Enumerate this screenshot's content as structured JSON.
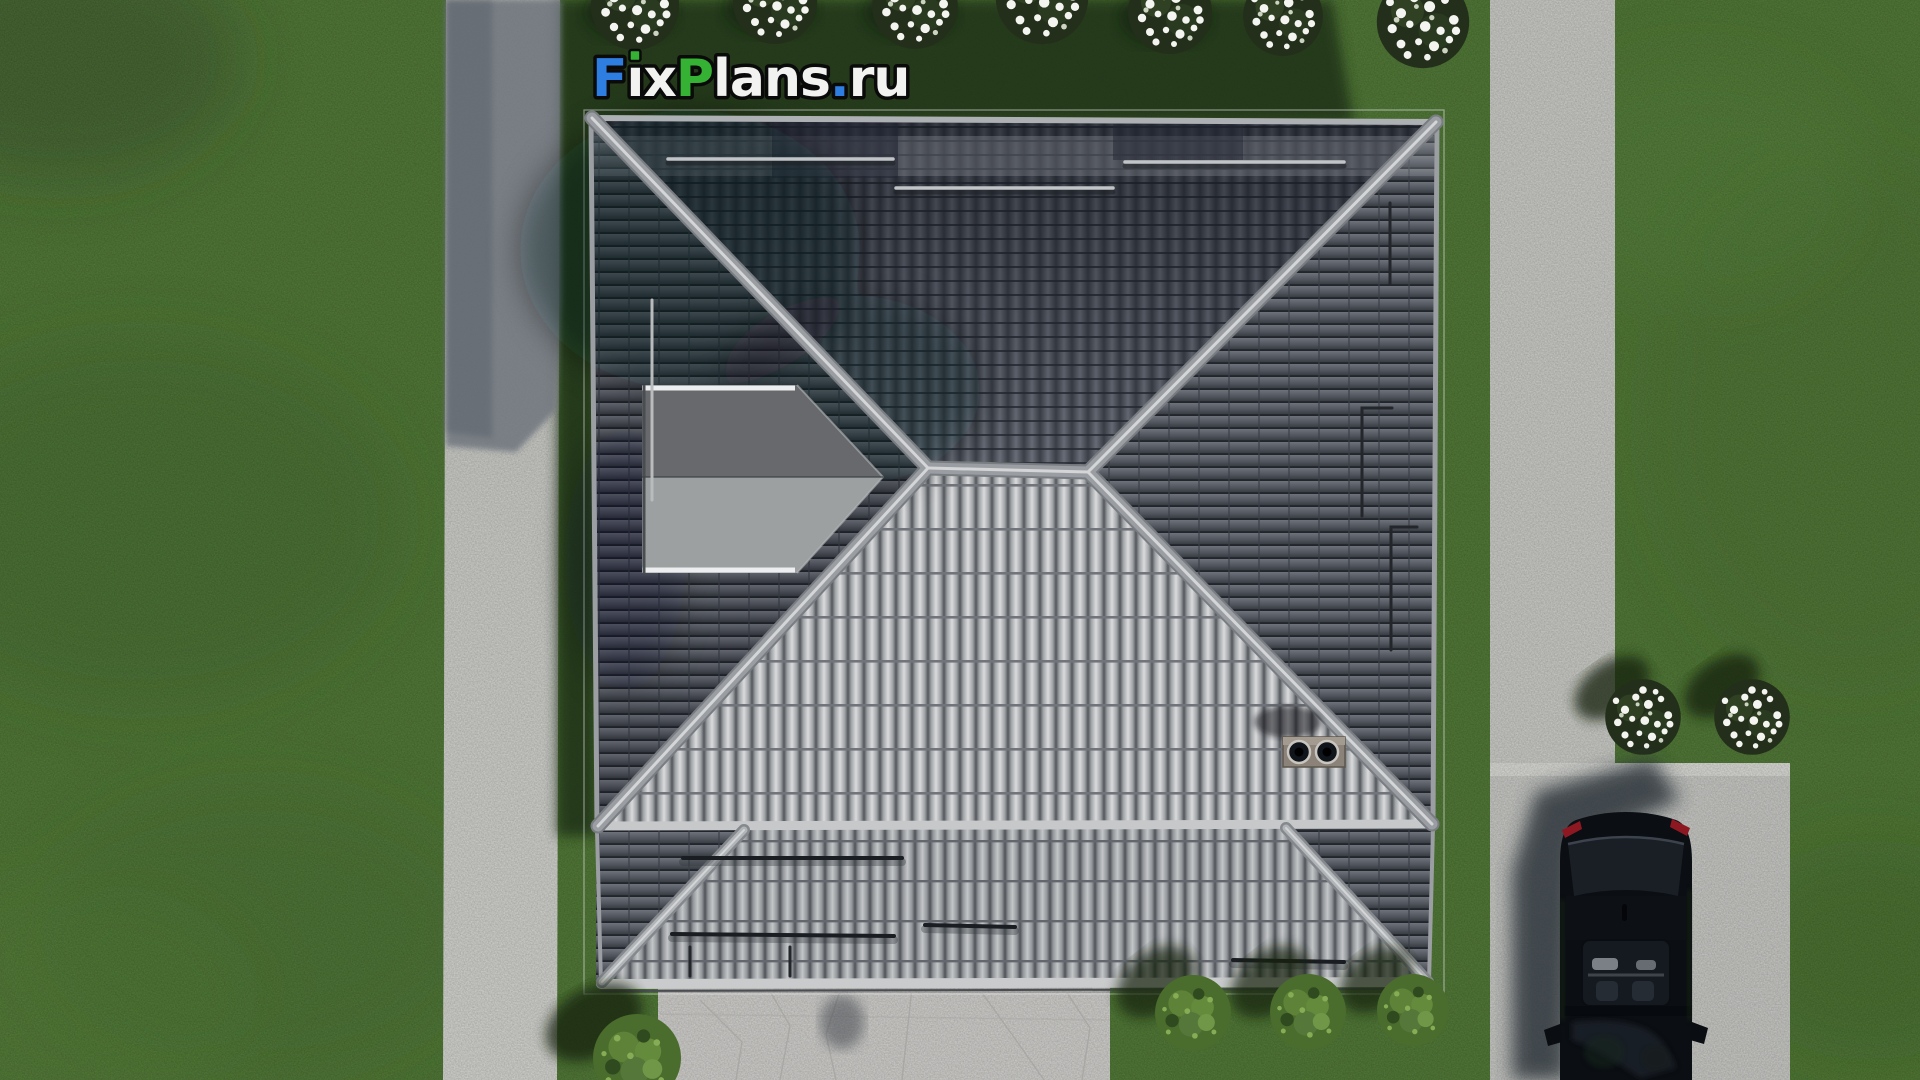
{
  "scene": {
    "watermark": {
      "text": "FixPlans.ru",
      "parts": [
        {
          "text": "F",
          "color": "#2e7de0"
        },
        {
          "text": "ı",
          "color": "#f2f3f1"
        },
        {
          "text": "x",
          "color": "#f2f3f1"
        },
        {
          "text": "P",
          "color": "#35b234"
        },
        {
          "text": "lans",
          "color": "#f2f3f1"
        },
        {
          "text": ".",
          "color": "#2e7de0"
        },
        {
          "text": "ru",
          "color": "#f2f3f1"
        }
      ],
      "i_dot_color": "#35b234",
      "outline_color": "#0a0a0a"
    },
    "palette": {
      "grass": "#4b7430",
      "grass_shadow": "#1d2f18",
      "walkway": "#c9cac5",
      "parking_pad": "#c6c7c3",
      "driveway": "#cfcecb",
      "roof_dark": "#53565c",
      "roof_light": "#9fa2a4",
      "ridge": "#9a9da1",
      "eave": "#c6c8ca",
      "skylight_upper": "#67696c",
      "skylight_lower": "#9da0a1",
      "chimney": "#8b8279",
      "car_body": "#0b0e12",
      "taillight": "#8e1822",
      "flower_white": "#f4f5f0",
      "bush_green": "#4e7030"
    },
    "objects": {
      "roof": "hip roof with gray tiles, top view",
      "annex_roof": "lower hip roof section at bottom",
      "skylight": "wedge-shaped skylight on left slope",
      "chimney": "chimney block with two round vents",
      "car": "black car parked on concrete pad",
      "left_walkway": "vertical concrete walkway, left",
      "right_walkway": "vertical concrete walkway, right",
      "parking_pad": "concrete parking pad, bottom right",
      "driveway": "stone paved driveway, bottom center",
      "flower_bush_count_top": 7,
      "flower_bush_count_right": 2,
      "green_bush_count": 4
    }
  }
}
